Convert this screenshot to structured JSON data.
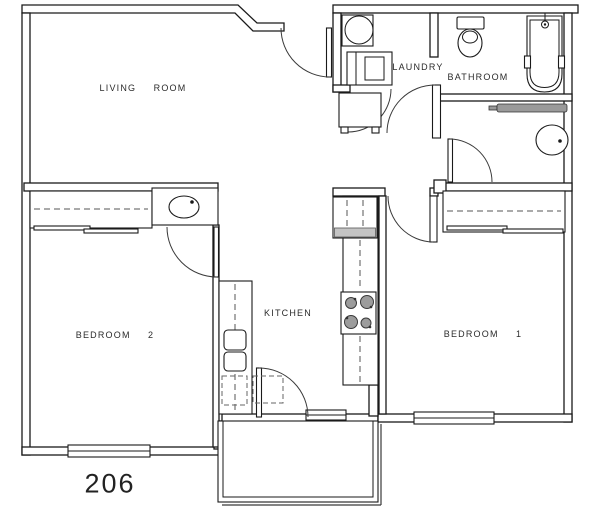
{
  "plan": {
    "unit_number": "206",
    "rooms": {
      "living_room": "LIVING  ROOM",
      "laundry": "LAUNDRY",
      "bathroom": "BATHROOM",
      "kitchen": "KITCHEN",
      "bedroom_1": "BEDROOM  1",
      "bedroom_2": "BEDROOM  2"
    },
    "fixtures": [
      "water-heater",
      "washer-dryer",
      "mechanical-chase",
      "toilet",
      "bathtub",
      "vanity-counter",
      "round-sink",
      "oval-sink",
      "refrigerator",
      "range-cooktop",
      "double-sink",
      "dishwasher",
      "closet-rod",
      "bypass-doors",
      "balcony",
      "entry-sill"
    ],
    "colors": {
      "line": "#1a1a1a",
      "counter_gray": "#9a9a9a",
      "appliance_band": "#c4c4c4",
      "burner_gray": "#9c9c9c",
      "text": "#2b2b2b"
    }
  }
}
